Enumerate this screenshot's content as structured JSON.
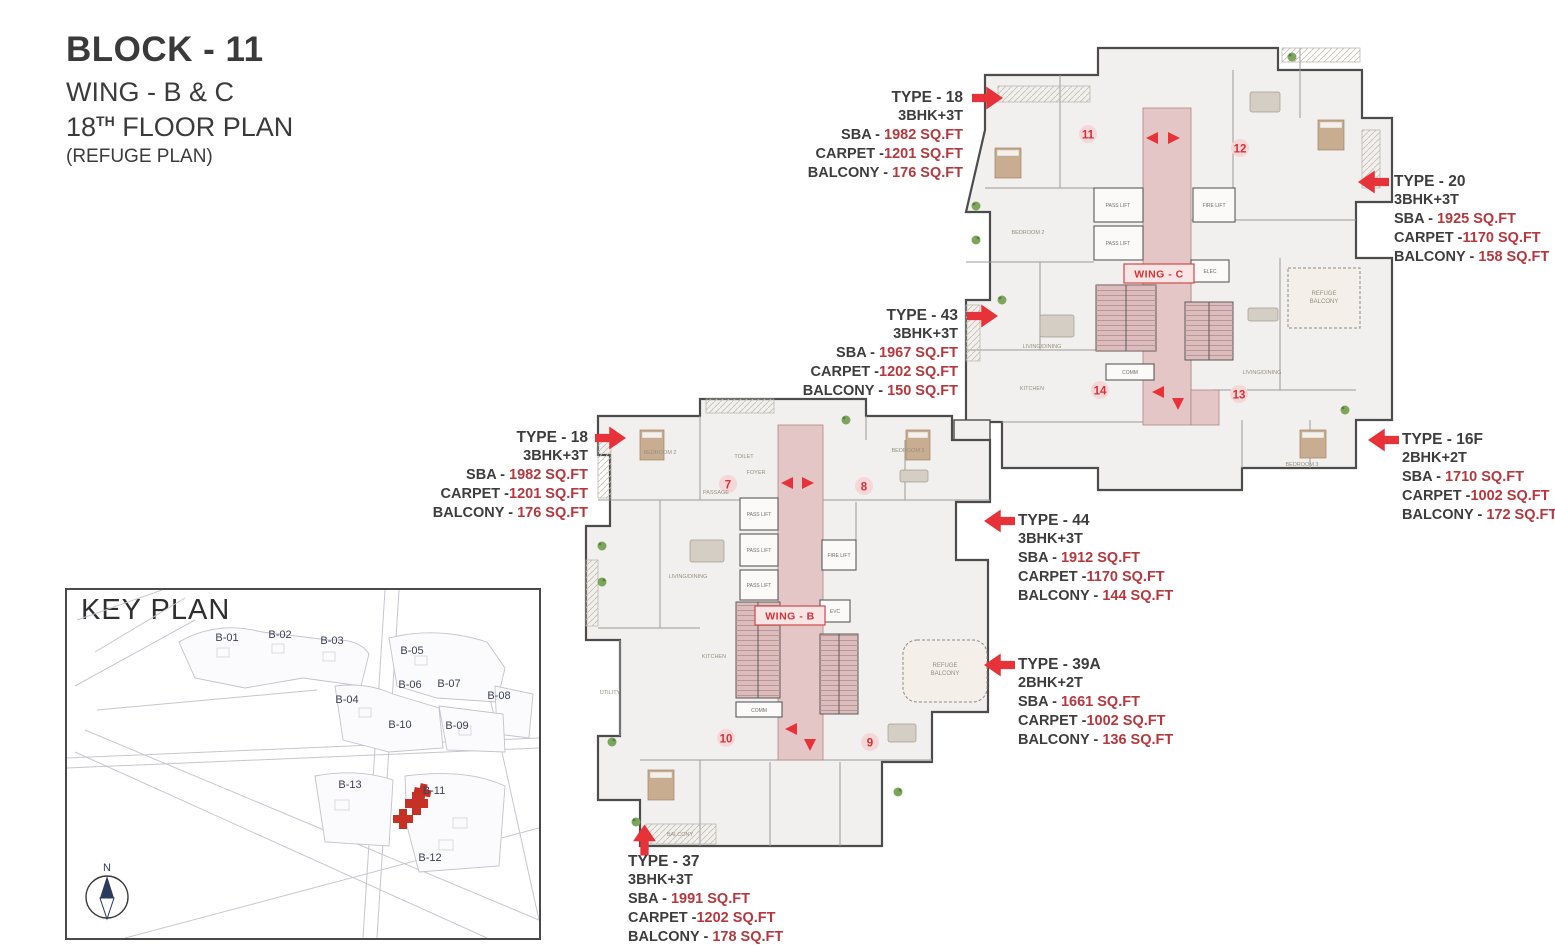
{
  "header": {
    "block": "BLOCK - 11",
    "wing": "WING - B & C",
    "floor_num": "18",
    "floor_sup": "TH",
    "floor_rest": " FLOOR PLAN",
    "refuge": "(REFUGE PLAN)"
  },
  "colors": {
    "accent_red": "#e63238",
    "value_red": "#b5383e",
    "text_dark": "#3b3b3b",
    "corridor_pink": "#e4c6c6"
  },
  "annotations": [
    {
      "title": "TYPE - 18",
      "config": "3BHK+3T",
      "rows": [
        {
          "label": "SBA - ",
          "value": "1982 SQ.FT"
        },
        {
          "label": "CARPET -",
          "value": "1201 SQ.FT"
        },
        {
          "label": "BALCONY - ",
          "value": "176 SQ.FT"
        }
      ]
    },
    {
      "title": "TYPE - 20",
      "config": "3BHK+3T",
      "rows": [
        {
          "label": "SBA - ",
          "value": "1925 SQ.FT"
        },
        {
          "label": "CARPET -",
          "value": "1170 SQ.FT"
        },
        {
          "label": "BALCONY - ",
          "value": "158 SQ.FT"
        }
      ]
    },
    {
      "title": "TYPE - 43",
      "config": "3BHK+3T",
      "rows": [
        {
          "label": "SBA - ",
          "value": "1967 SQ.FT"
        },
        {
          "label": "CARPET -",
          "value": "1202 SQ.FT"
        },
        {
          "label": "BALCONY - ",
          "value": "150 SQ.FT"
        }
      ]
    },
    {
      "title": "TYPE - 18",
      "config": "3BHK+3T",
      "rows": [
        {
          "label": "SBA - ",
          "value": "1982 SQ.FT"
        },
        {
          "label": "CARPET -",
          "value": "1201 SQ.FT"
        },
        {
          "label": "BALCONY - ",
          "value": "176 SQ.FT"
        }
      ]
    },
    {
      "title": "TYPE - 16F",
      "config": "2BHK+2T",
      "rows": [
        {
          "label": "SBA - ",
          "value": "1710 SQ.FT"
        },
        {
          "label": "CARPET -",
          "value": "1002 SQ.FT"
        },
        {
          "label": "BALCONY - ",
          "value": "172 SQ.FT"
        }
      ]
    },
    {
      "title": "TYPE - 44",
      "config": "3BHK+3T",
      "rows": [
        {
          "label": "SBA - ",
          "value": "1912 SQ.FT"
        },
        {
          "label": "CARPET -",
          "value": "1170 SQ.FT"
        },
        {
          "label": "BALCONY - ",
          "value": "144 SQ.FT"
        }
      ]
    },
    {
      "title": "TYPE - 39A",
      "config": "2BHK+2T",
      "rows": [
        {
          "label": "SBA - ",
          "value": "1661 SQ.FT"
        },
        {
          "label": "CARPET -",
          "value": "1002 SQ.FT"
        },
        {
          "label": "BALCONY - ",
          "value": "136 SQ.FT"
        }
      ]
    },
    {
      "title": "TYPE - 37",
      "config": "3BHK+3T",
      "rows": [
        {
          "label": "SBA - ",
          "value": "1991 SQ.FT"
        },
        {
          "label": "CARPET -",
          "value": "1202 SQ.FT"
        },
        {
          "label": "BALCONY - ",
          "value": "178 SQ.FT"
        }
      ]
    }
  ],
  "plan": {
    "wing_b": "WING - B",
    "wing_c": "WING - C",
    "units": {
      "u7": "7",
      "u8": "8",
      "u9": "9",
      "u10": "10",
      "u11": "11",
      "u12": "12",
      "u13": "13",
      "u14": "14"
    },
    "labels": {
      "pass_lift": "PASS LIFT",
      "fire_lift": "FIRE LIFT",
      "elec": "ELEC",
      "evc": "EVC",
      "comm": "COMM",
      "refuge_1": "REFUGE",
      "refuge_2": "BALCONY"
    },
    "room_labels": [
      "BEDROOM 2",
      "BEDROOM 3",
      "LIVING/DINING",
      "KITCHEN",
      "TOILET",
      "PASSAGE",
      "FOYER",
      "BALCONY",
      "UTILITY",
      "LIVING/DINING",
      "KITCHEN",
      "BEDROOM 3"
    ]
  },
  "keyplan": {
    "title": "KEY PLAN",
    "compass": "N",
    "blocks": [
      "B-01",
      "B-02",
      "B-03",
      "B-04",
      "B-05",
      "B-06",
      "B-07",
      "B-08",
      "B-09",
      "B-10",
      "B-11",
      "B-12",
      "B-13"
    ]
  }
}
